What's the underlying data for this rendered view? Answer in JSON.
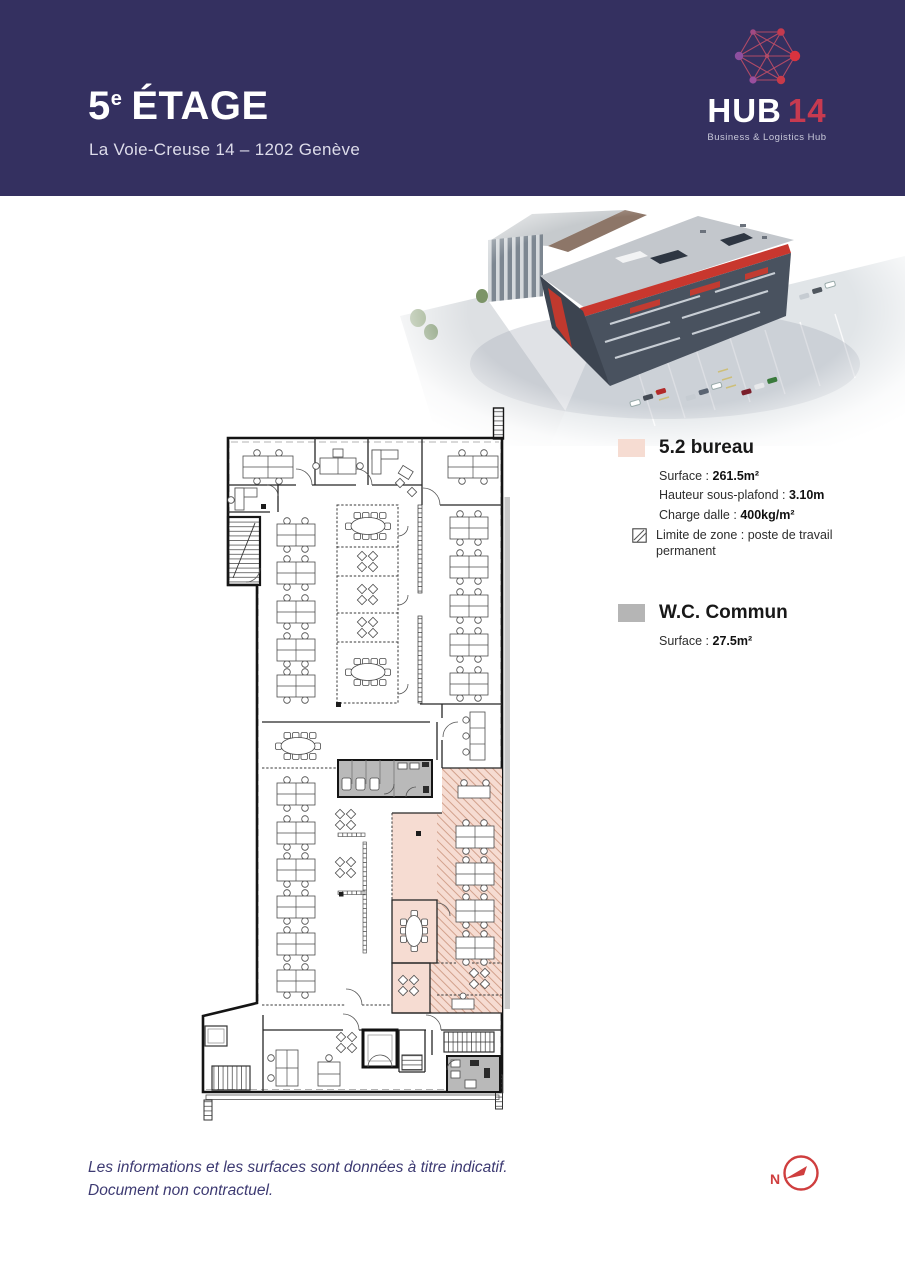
{
  "header": {
    "floor": "5",
    "floor_sup": "e",
    "floor_word": "ÉTAGE",
    "subtitle": "La Voie-Creuse 14 – 1202 Genève"
  },
  "logo": {
    "brand": "HUB",
    "number": "14",
    "tagline": "Business & Logistics Hub"
  },
  "legend": {
    "bureau": {
      "title": "5.2 bureau",
      "surface_label": "Surface : ",
      "surface_value": "261.5m²",
      "height_label": "Hauteur sous-plafond : ",
      "height_value": "3.10m",
      "load_label": "Charge dalle : ",
      "load_value": "400kg/m²",
      "zone_note": "Limite de zone : poste de travail permanent"
    },
    "wc": {
      "title": "W.C. Commun",
      "surface_label": "Surface : ",
      "surface_value": "27.5m²"
    }
  },
  "footer": {
    "line1": "Les informations et les surfaces sont données à titre indicatif.",
    "line2": "Document non contractuel.",
    "compass_label": "N"
  },
  "colors": {
    "header_bg": "#343060",
    "accent_red": "#c73a50",
    "zone_pink": "#f6dcd2",
    "zone_gray": "#b5b5b5",
    "compass_red": "#cf3e3e",
    "footer_navy": "#3d3a72"
  }
}
